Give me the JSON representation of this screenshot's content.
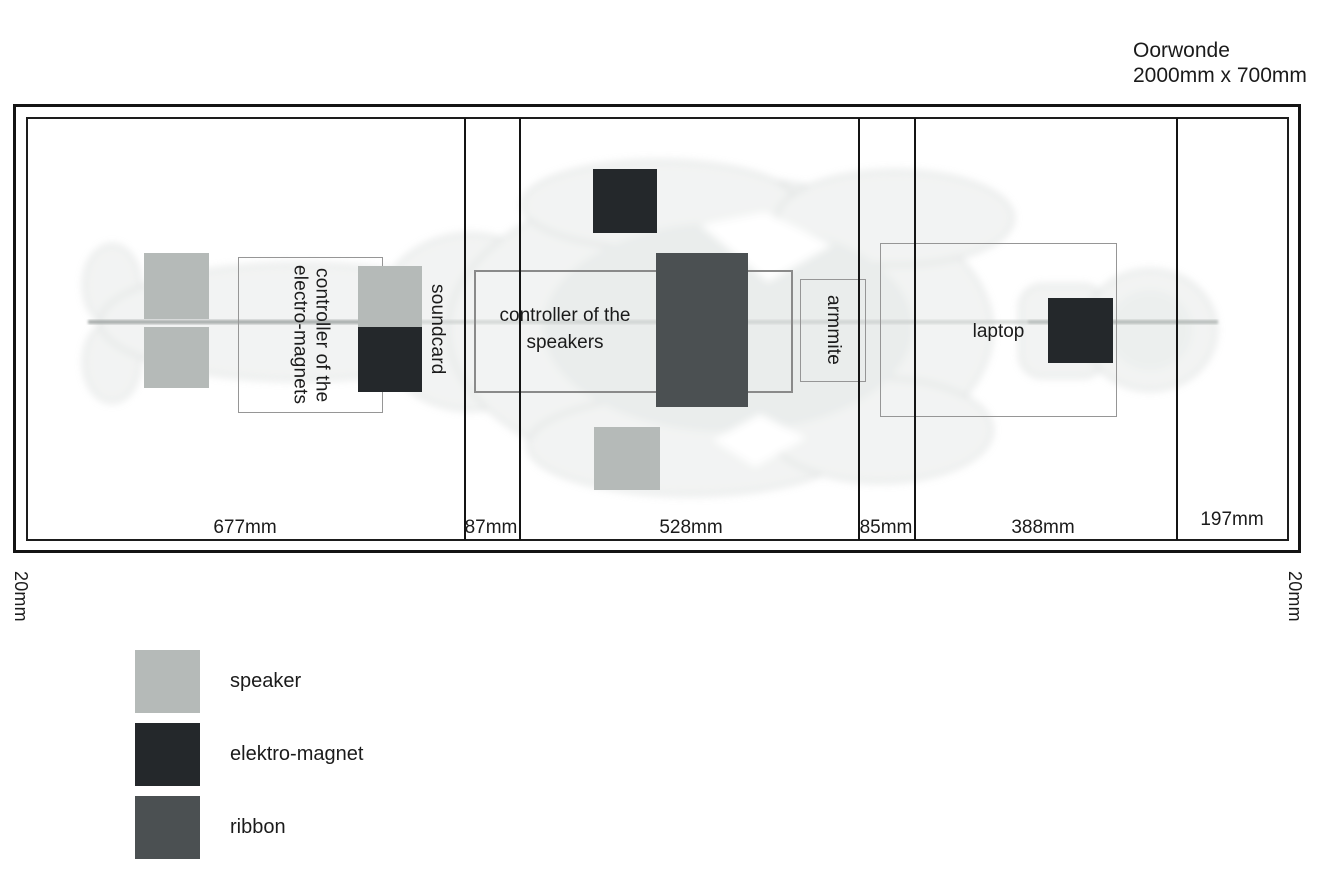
{
  "title": {
    "name": "Oorwonde",
    "size": "2000mm x 700mm"
  },
  "plan": {
    "margin_left": "20mm",
    "margin_right": "20mm",
    "sections": [
      {
        "width_label": "677mm"
      },
      {
        "width_label": "87mm"
      },
      {
        "width_label": "528mm"
      },
      {
        "width_label": "85mm"
      },
      {
        "width_label": "388mm"
      },
      {
        "width_label": "197mm"
      }
    ],
    "labels": {
      "electro_controller": "controller of the\nelectro-magnets",
      "soundcard": "soundcard",
      "speakers_controller": "controller of the\nspeakers",
      "armmite": "armmite",
      "laptop": "laptop"
    }
  },
  "colors": {
    "speaker": "#b5bab8",
    "elektro_magnet": "#24282b",
    "ribbon": "#4b5052"
  },
  "legend": {
    "items": [
      {
        "label": "speaker",
        "color": "#b5bab8"
      },
      {
        "label": "elektro-magnet",
        "color": "#24282b"
      },
      {
        "label": "ribbon",
        "color": "#4b5052"
      }
    ]
  }
}
